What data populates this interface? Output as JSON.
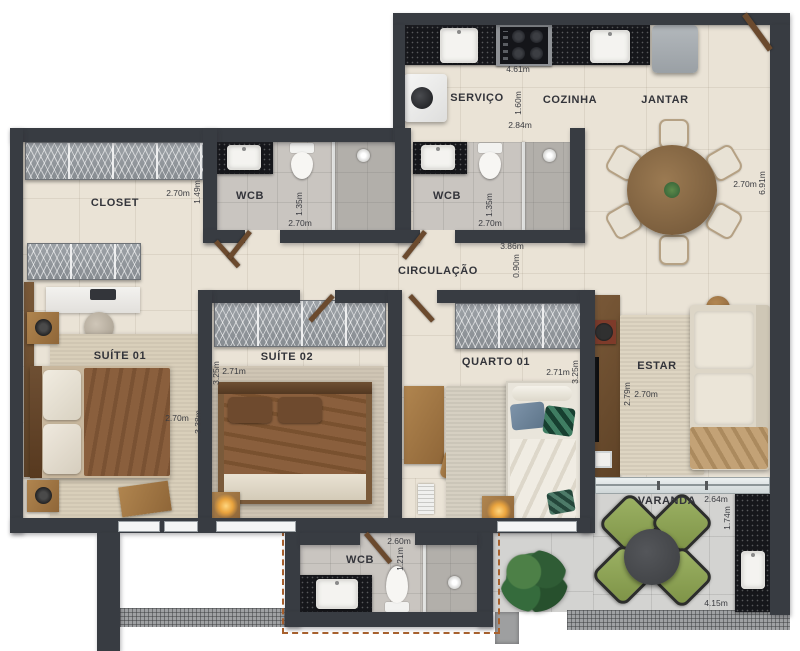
{
  "plan_title": "Apartment floor plan (top view render)",
  "labels": {
    "servico": "SERVIÇO",
    "cozinha": "COZINHA",
    "jantar": "JANTAR",
    "closet": "CLOSET",
    "wcb1": "WCB",
    "wcb2": "WCB",
    "wcb3": "WCB",
    "circulacao": "CIRCULAÇÃO",
    "suite01": "SUÍTE 01",
    "suite02": "SUÍTE 02",
    "quarto01": "QUARTO 01",
    "estar": "ESTAR",
    "varanda": "VARANDA"
  },
  "measurements": {
    "cozinha_w": "4.61m",
    "servico_d": "1.60m",
    "servico_w": "2.84m",
    "closet_w": "2.70m",
    "closet_d": "1.49m",
    "jantar_w": "2.70m",
    "jantar_d": "6.91m",
    "wcb1_d": "1.35m",
    "wcb1_w": "2.70m",
    "wcb2_d": "1.35m",
    "wcb2_w": "2.70m",
    "circulacao_w": "3.86m",
    "circulacao_d": "0.90m",
    "suite01_w": "2.70m",
    "suite01_d": "3.38m",
    "suite02_d": "3.25m",
    "suite02_w": "2.71m",
    "quarto01_w": "2.71m",
    "quarto01_d": "3.25m",
    "estar_d": "2.79m",
    "estar_w": "2.70m",
    "varanda_w": "2.64m",
    "varanda_d": "1.74m",
    "varanda_total_w": "4.15m",
    "wcb3_w": "2.60m",
    "wcb3_d": "1.21m"
  },
  "colors": {
    "wall": "#383c42",
    "floor_beige": "#eae3d6",
    "floor_bath": "#c9c5c0",
    "floor_varanda": "#d3d3d1",
    "granite": "#16171b",
    "wood": "#a87848",
    "duvet_brown": "#8a5f3d",
    "chair_green": "#8da356"
  }
}
